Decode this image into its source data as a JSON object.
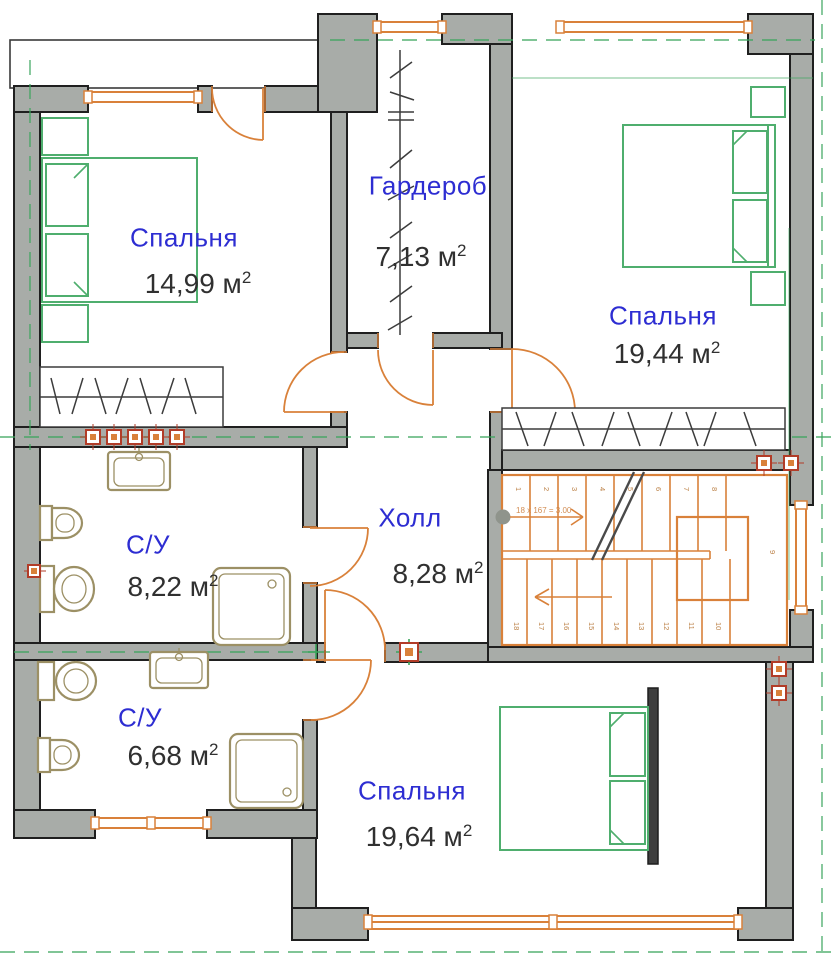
{
  "plan": {
    "rooms": [
      {
        "id": "bedroom-1",
        "name": "Спальня",
        "area": "14,99 м",
        "sup": "2"
      },
      {
        "id": "wardrobe",
        "name": "Гардероб",
        "area": "7,13 м",
        "sup": "2"
      },
      {
        "id": "bedroom-2",
        "name": "Спальня",
        "area": "19,44 м",
        "sup": "2"
      },
      {
        "id": "bathroom-1",
        "name": "С/У",
        "area": "8,22 м",
        "sup": "2"
      },
      {
        "id": "hall",
        "name": "Холл",
        "area": "8,28 м",
        "sup": "2"
      },
      {
        "id": "bathroom-2",
        "name": "С/У",
        "area": "6,68 м",
        "sup": "2"
      },
      {
        "id": "bedroom-3",
        "name": "Спальня",
        "area": "19,64 м",
        "sup": "2"
      }
    ],
    "stairs": {
      "annotation": "18 x 167 = 3.00",
      "landing": "9",
      "steps": [
        "1",
        "2",
        "3",
        "4",
        "5",
        "6",
        "7",
        "8",
        "9",
        "10",
        "11",
        "12",
        "13",
        "14",
        "15",
        "16",
        "17",
        "18"
      ]
    },
    "colors": {
      "wall_fill": "#a8aca8",
      "wall_line": "#1f1f1f",
      "orange": "#d9813a",
      "green": "#4fae6e",
      "fixture": "#9c9065",
      "label_blue": "#2d2dd2",
      "label_dark": "#303030",
      "axis_green": "#3aa55c",
      "marker_red": "#b23c28"
    }
  }
}
